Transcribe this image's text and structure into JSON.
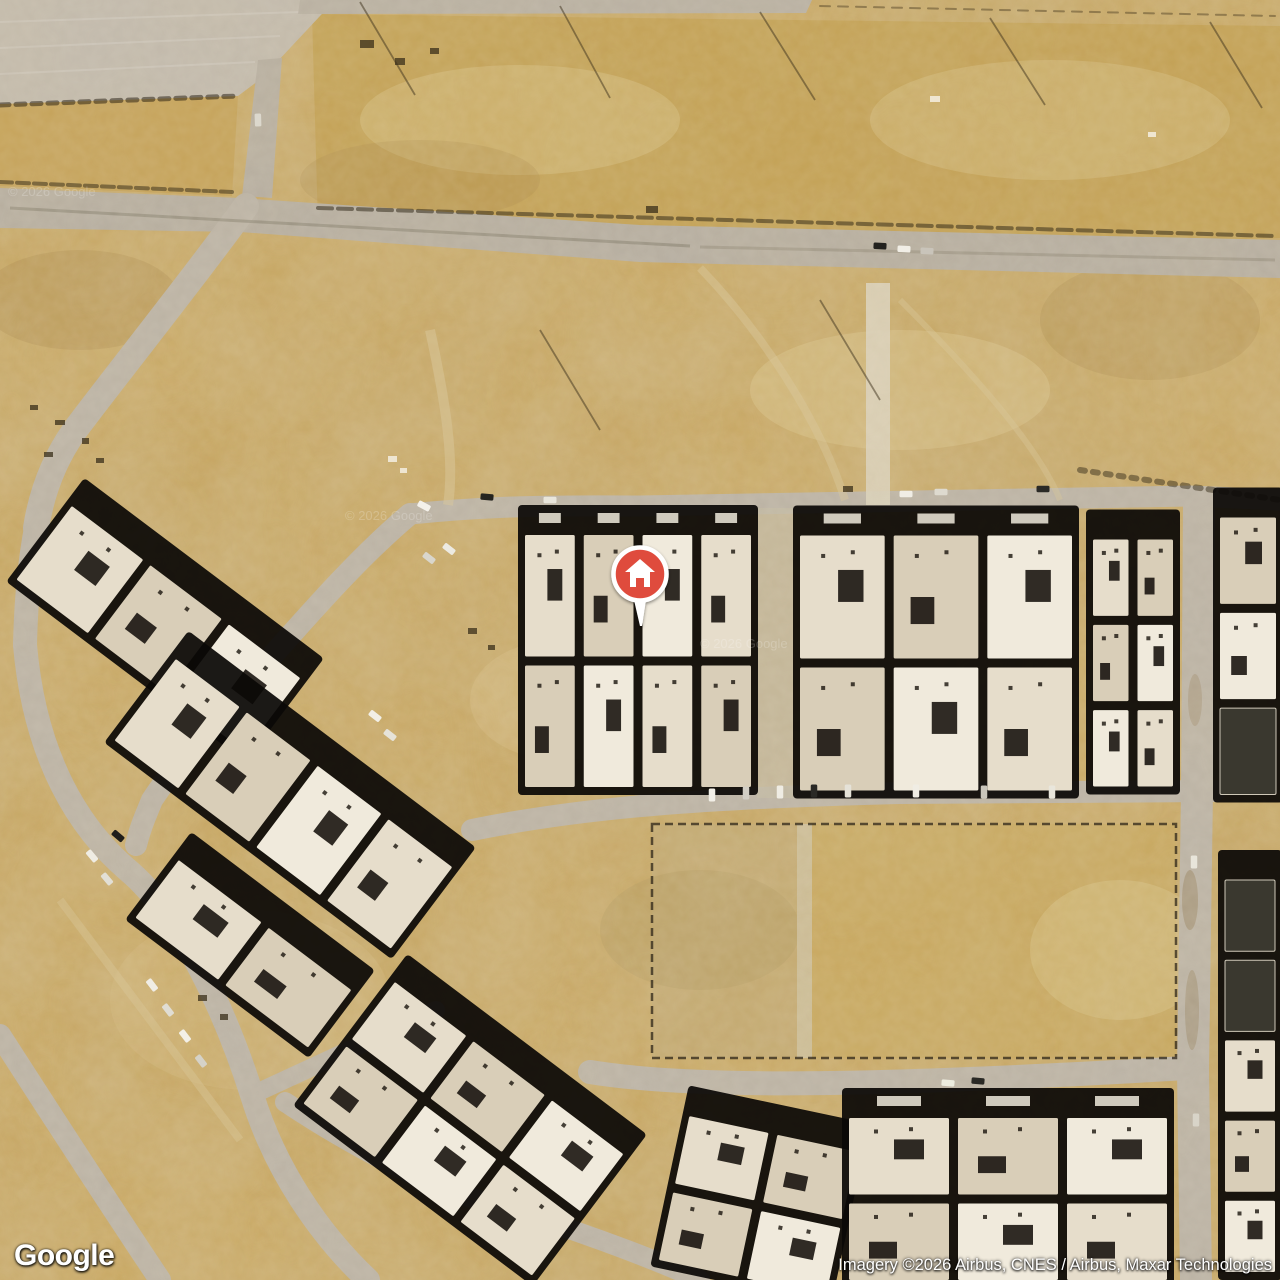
{
  "branding": {
    "logo_text": "Google"
  },
  "attribution": {
    "text": "Imagery ©2026 Airbus, CNES / Airbus, Maxar Technologies"
  },
  "watermarks": {
    "text": "© 2026 Google"
  },
  "marker": {
    "icon": "home",
    "style": "red-circle-pin"
  },
  "palette": {
    "desert_base": "#c8a65f",
    "desert_light": "#e2cf9d",
    "desert_dark": "#a9884b",
    "road": "#bbb3a6",
    "clear_area": "#c2baad",
    "shadow": "#0b0906",
    "roof_light": "#e6ddcb",
    "roof_mid": "#d9ceb8",
    "roof_bright": "#f0eadc",
    "roof_dark": "#3a382f",
    "pin_red": "#df4b3c",
    "pin_ring": "#ffffff",
    "attr_text": "#ffffff"
  }
}
